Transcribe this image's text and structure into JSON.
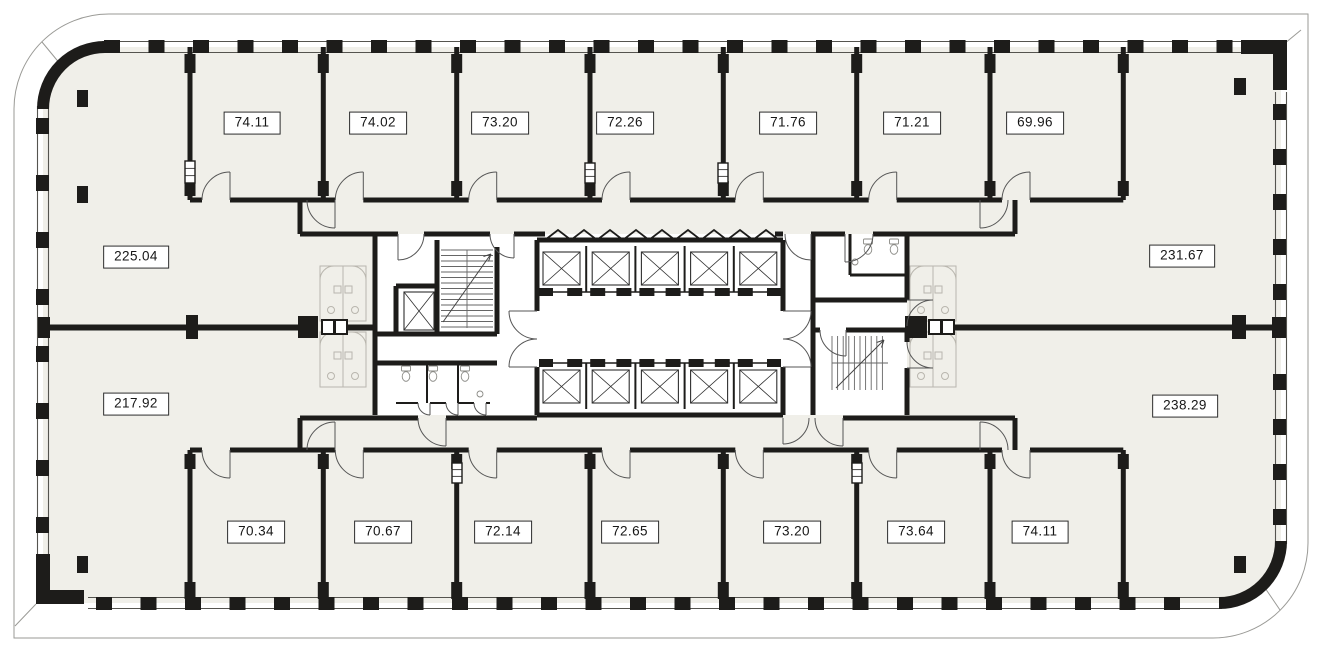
{
  "plan": {
    "type": "office-floor-plan",
    "area_labels": {
      "top": [
        "74.11",
        "74.02",
        "73.20",
        "72.26",
        "71.76",
        "71.21",
        "69.96"
      ],
      "bottom": [
        "70.34",
        "70.67",
        "72.14",
        "72.65",
        "73.20",
        "73.64",
        "74.11"
      ],
      "left": [
        "225.04",
        "217.92"
      ],
      "right": [
        "231.67",
        "238.29"
      ]
    },
    "colors": {
      "floor": "#f0efe9",
      "core_floor": "#ffffff",
      "wall": "#1d1c1a",
      "window_line": "#55544f",
      "site_outline": "#9a9a96",
      "door_arc": "#555555",
      "stair_line": "#666666",
      "furniture": "#b9b6ae",
      "label_bg": "#ffffff",
      "label_border": "#2b2b2b"
    }
  }
}
